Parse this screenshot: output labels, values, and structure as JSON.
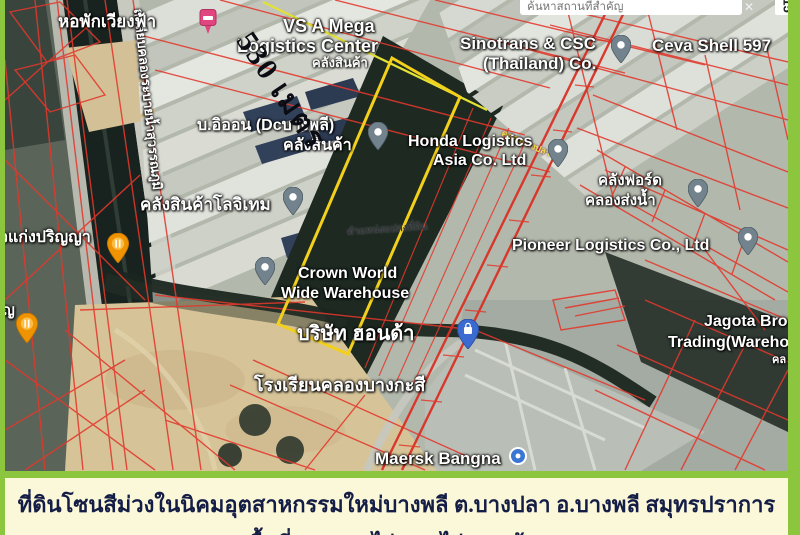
{
  "app": {
    "search": {
      "placeholder": "ค้นหาสถานที่สำคัญ"
    },
    "close_button": "✕",
    "corner_badge": "15"
  },
  "map": {
    "distance_label": "530 เมตร",
    "plot_marker_label": "ตำแหน่งแปลงที่ดิน",
    "canal_road_label": "ถ.เลียบคลองระบายน้ำสุวรรณภูมิ",
    "small_road_label": "คลองบางปลา",
    "labels": [
      {
        "text": "หอพักเวียงฟ้า"
      },
      {
        "text": "VS A Mega"
      },
      {
        "text": "Logistics Center"
      },
      {
        "text": "คลังสินค้า"
      },
      {
        "text": "Sinotrans & CSC"
      },
      {
        "text": "(Thailand) Co."
      },
      {
        "text": "Ceva Shell 597"
      },
      {
        "text": "บ.อิออน (Dcบางพลี)"
      },
      {
        "text": "คลังสินค้า"
      },
      {
        "text": "Honda Logistics"
      },
      {
        "text": "Asia Co.  Ltd"
      },
      {
        "text": "คลังฟอร์ด"
      },
      {
        "text": "คลองส่งน้ำ"
      },
      {
        "text": "คลังสินค้าโลจิเทม"
      },
      {
        "text": "Pioneer Logistics Co., Ltd"
      },
      {
        "text": "วแก่งปริญญา"
      },
      {
        "text": "Crown World"
      },
      {
        "text": "Wide Warehouse"
      },
      {
        "text": "Jagota Bro"
      },
      {
        "text": "Trading(Wareho"
      },
      {
        "text": "คล"
      },
      {
        "text": "บริษัท ฮอนด้า"
      },
      {
        "text": "โรงเรียนคลองบางกะสี"
      },
      {
        "text": "Maersk Bangna"
      },
      {
        "text": "ญ"
      }
    ]
  },
  "caption": {
    "line1": "ที่ดินโซนสีม่วงในนิคมอุตสาหกรรมใหม่บางพลี ต.บางปลา อ.บางพลี สมุทรปราการ",
    "line2_pre": "เนื้อที่ ",
    "line2_highlight": "28-3-88",
    "line2_post": " ไร่ ขายไร่ละ 8 ล้าน"
  },
  "colors": {
    "frame_green": "#8cc63e",
    "caption_bg": "#fbf7d9",
    "caption_text": "#141d45",
    "highlight_red": "#e0391f",
    "cadastral_red": "#e2382c",
    "plot_yellow": "#f3d01c"
  }
}
